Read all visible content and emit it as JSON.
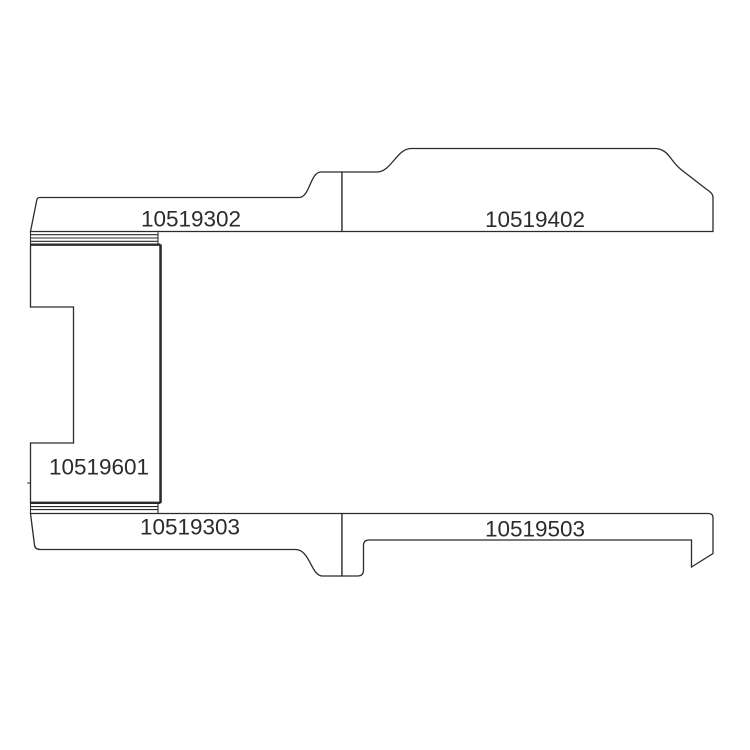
{
  "page": {
    "background_color": "#ffffff",
    "line_color": "#2b2b2b"
  },
  "diagram": {
    "type": "flat-pattern parts diagram",
    "panels": [
      {
        "id": "top-left-panel",
        "part_number": "10519302"
      },
      {
        "id": "top-right-panel",
        "part_number": "10519402"
      },
      {
        "id": "left-vertical-panel",
        "part_number": "10519601"
      },
      {
        "id": "bottom-left-panel",
        "part_number": "10519303"
      },
      {
        "id": "bottom-right-panel",
        "part_number": "10519503"
      }
    ]
  }
}
